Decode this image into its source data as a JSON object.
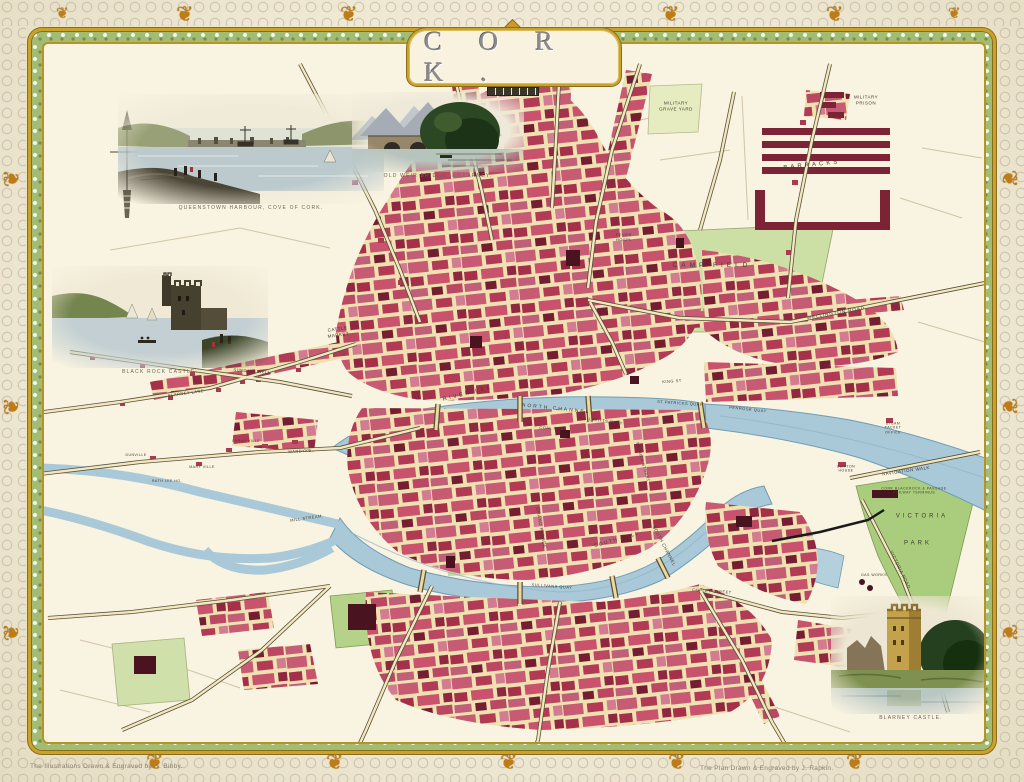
{
  "title": "C O R K .",
  "icons": {
    "ornament": "❦"
  },
  "credits": {
    "left": "The Illustrations Drawn & Engraved by H. Bibby.",
    "right": "The Plan Drawn & Engraved by J. Rapkin."
  },
  "vignettes": [
    {
      "id": "queenstown-harbour",
      "caption": "QUEENSTOWN HARBOUR, COVE OF CORK."
    },
    {
      "id": "old-weir-bridge",
      "caption": "OLD WEIR BRIDGE, KILLARNEY."
    },
    {
      "id": "black-rock-castle",
      "caption": "BLACK ROCK CASTLE."
    },
    {
      "id": "blarney-castle",
      "caption": "BLARNEY CASTLE."
    }
  ],
  "map": {
    "labels": [
      {
        "t": "MILITARY\nGRAVE YARD",
        "x": 676,
        "y": 106,
        "s": 4.5
      },
      {
        "t": "MILITARY\nPRISON",
        "x": 866,
        "y": 100,
        "s": 4.5
      },
      {
        "t": "BARRACKS",
        "x": 812,
        "y": 166,
        "s": 6,
        "ls": 3,
        "r": -6
      },
      {
        "t": "CAMP FIELD",
        "x": 712,
        "y": 266,
        "s": 6.5,
        "ls": 4
      },
      {
        "t": "WELLINGTON ROAD",
        "x": 836,
        "y": 313,
        "s": 4.5,
        "ls": 1,
        "r": -10
      },
      {
        "t": "FEVER\nHOSPL",
        "x": 624,
        "y": 237,
        "s": 4
      },
      {
        "t": "CATTLE\nMARKET",
        "x": 338,
        "y": 332,
        "s": 4.5,
        "r": -8
      },
      {
        "t": "RIVER LEE",
        "x": 468,
        "y": 394,
        "s": 5.5,
        "ls": 2.5,
        "r": -14
      },
      {
        "t": "NORTH CHANNEL",
        "x": 556,
        "y": 409,
        "s": 5,
        "ls": 2,
        "r": 6
      },
      {
        "t": "COAL QUAY",
        "x": 553,
        "y": 428,
        "s": 4,
        "r": 2
      },
      {
        "t": "LAVITTS QUAY",
        "x": 606,
        "y": 421,
        "s": 4,
        "r": 8
      },
      {
        "t": "ST PATRICKS QUAY",
        "x": 680,
        "y": 403,
        "s": 4,
        "r": 4
      },
      {
        "t": "PENROSE QUAY",
        "x": 748,
        "y": 409,
        "s": 4,
        "r": 6
      },
      {
        "t": "KING ST",
        "x": 672,
        "y": 381,
        "s": 4,
        "r": -4
      },
      {
        "t": "PATRICK STREET",
        "x": 643,
        "y": 462,
        "s": 4,
        "r": 74
      },
      {
        "t": "SOUTH MALL",
        "x": 617,
        "y": 540,
        "s": 5,
        "ls": 1.5,
        "r": -16
      },
      {
        "t": "GRAND PARADE",
        "x": 541,
        "y": 528,
        "s": 4.5,
        "r": 80
      },
      {
        "t": "SULLIVANS QUAY",
        "x": 552,
        "y": 586,
        "s": 4,
        "r": 4
      },
      {
        "t": "SOUTH CHANNEL",
        "x": 664,
        "y": 546,
        "s": 4.5,
        "r": 62
      },
      {
        "t": "COPLEY STREET",
        "x": 712,
        "y": 591,
        "s": 4,
        "r": 4
      },
      {
        "t": "NAVIGATION WALK",
        "x": 906,
        "y": 471,
        "s": 4.5,
        "r": -8
      },
      {
        "t": "CORK BLACKROCK & PASSAGE\nRAILWAY TERMINUS",
        "x": 914,
        "y": 491,
        "s": 3.5
      },
      {
        "t": "VICTORIA",
        "x": 922,
        "y": 517,
        "s": 6,
        "ls": 3
      },
      {
        "t": "PARK",
        "x": 918,
        "y": 544,
        "s": 6,
        "ls": 3
      },
      {
        "t": "VICTORIA ROAD",
        "x": 900,
        "y": 570,
        "s": 4.5,
        "r": 64
      },
      {
        "t": "GAS WORKS",
        "x": 874,
        "y": 575,
        "s": 3.5
      },
      {
        "t": "MILL STREAM",
        "x": 306,
        "y": 518,
        "s": 4,
        "r": -8
      },
      {
        "t": "MARDYKE",
        "x": 300,
        "y": 451,
        "s": 4,
        "r": -4
      },
      {
        "t": "BLARNEY LANE",
        "x": 186,
        "y": 393,
        "s": 4,
        "r": -8
      },
      {
        "t": "SUNDAYS WELL",
        "x": 252,
        "y": 371,
        "s": 4,
        "r": 4
      },
      {
        "t": "DUNVILLE",
        "x": 136,
        "y": 455,
        "s": 3.5
      },
      {
        "t": "MARY VILLE",
        "x": 202,
        "y": 467,
        "s": 3.5
      },
      {
        "t": "RATH LEE HO.",
        "x": 167,
        "y": 481,
        "s": 3.5
      },
      {
        "t": "SARAH VILLE",
        "x": 246,
        "y": 441,
        "s": 3.5
      },
      {
        "t": "CLIFTON\nHOUSE",
        "x": 846,
        "y": 469,
        "s": 3.5
      },
      {
        "t": "STEAM\nPACKET\nOFFICE",
        "x": 893,
        "y": 428,
        "s": 3.5
      }
    ]
  }
}
